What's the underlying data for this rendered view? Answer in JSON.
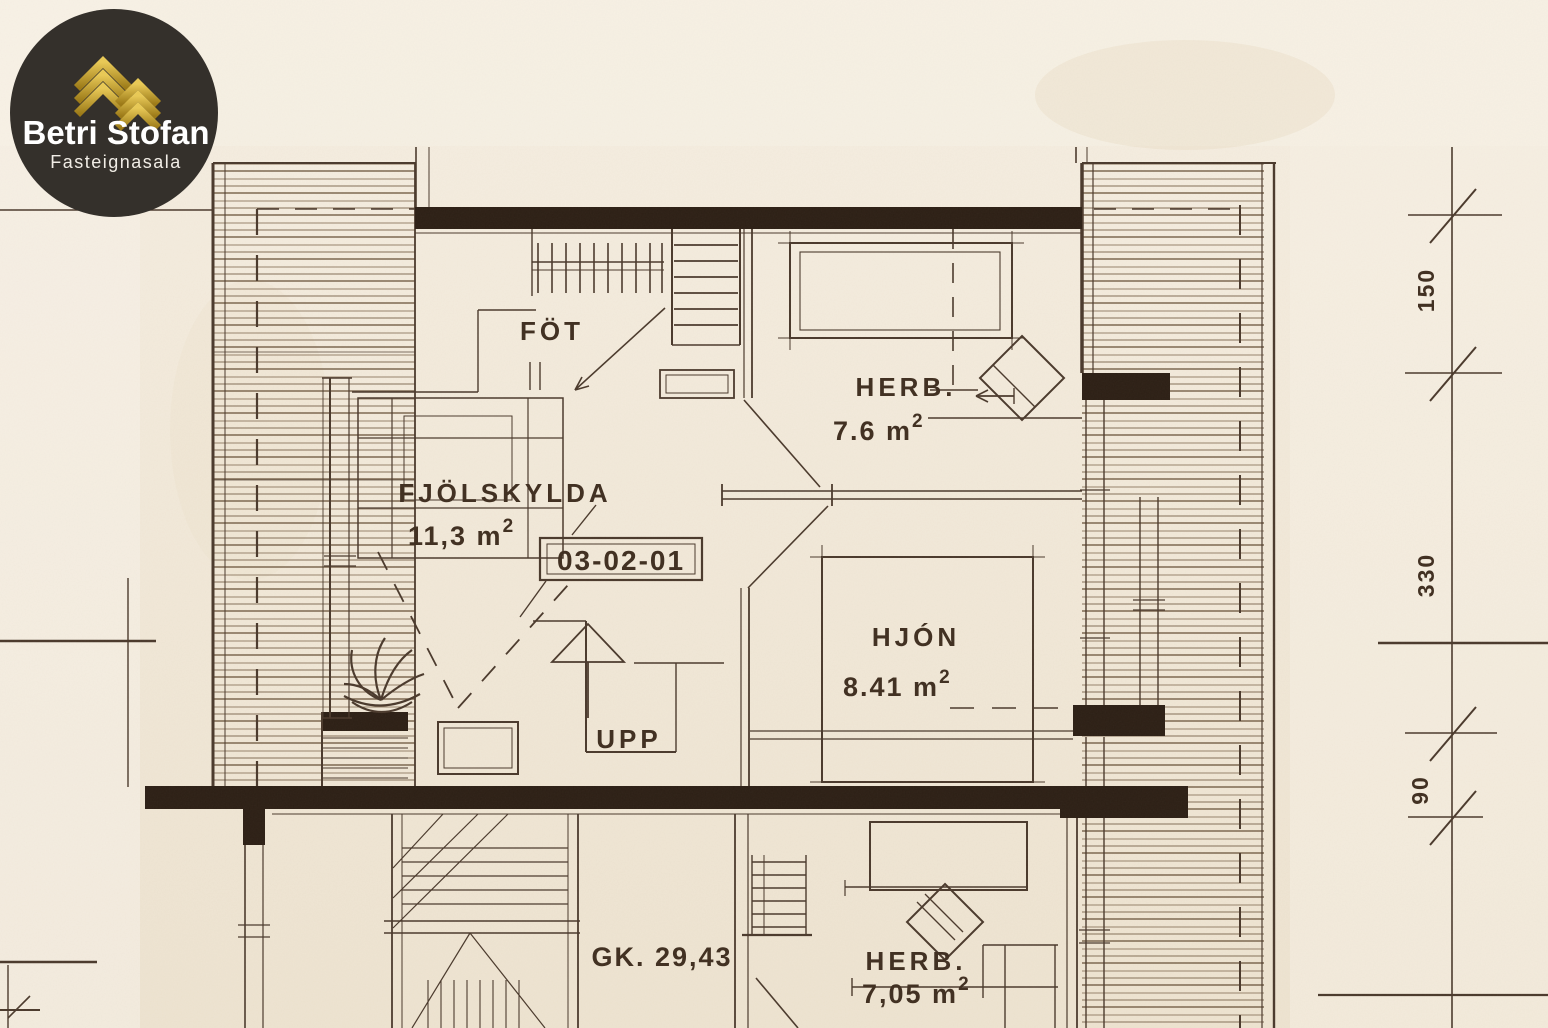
{
  "brand": {
    "name": "Betri Stofan",
    "tagline": "Fasteignasala"
  },
  "upper": {
    "closet": "FÖT",
    "bedroom": {
      "label": "HERB.",
      "area": "7.6 m",
      "sup": "2"
    },
    "family": {
      "label": "FJÖLSKYLDA",
      "area": "11,3 m",
      "sup": "2"
    },
    "unit_id": "03-02-01",
    "master": {
      "label": "HJÓN",
      "area": "8.41 m",
      "sup": "2"
    },
    "stairs": "UPP"
  },
  "lower": {
    "elevation": "GK. 29,43",
    "bedroom": {
      "label": "HERB.",
      "area": "7,05 m",
      "sup": "2"
    }
  },
  "dims": {
    "d1": "150",
    "d2": "330",
    "d3": "90"
  },
  "colors": {
    "paper": "#f2ebdc",
    "ink": "#4a392c",
    "wall": "#2c1f15",
    "gold": "#d4a62c",
    "logo_bg": "#34302b"
  }
}
